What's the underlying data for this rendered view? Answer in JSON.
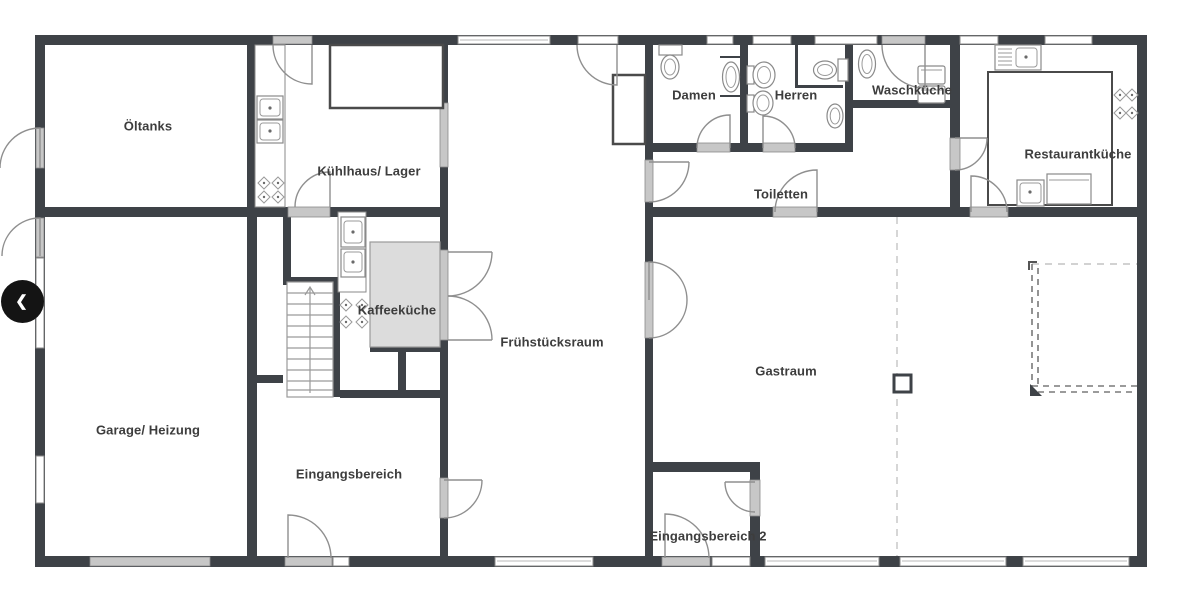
{
  "nav": {
    "prev_icon": "❮"
  },
  "rooms": {
    "oeltanks": {
      "label": "Öltanks"
    },
    "kuehlhaus": {
      "label": "Kühlhaus/ Lager"
    },
    "kaffeekueche": {
      "label": "Kaffeeküche"
    },
    "fruehstuecksraum": {
      "label": "Frühstücksraum"
    },
    "damen": {
      "label": "Damen"
    },
    "herren": {
      "label": "Herren"
    },
    "toiletten": {
      "label": "Toiletten"
    },
    "waschkueche": {
      "label": "Waschküche"
    },
    "restaurantkueche": {
      "label": "Restaurantküche"
    },
    "garage": {
      "label": "Garage/ Heizung"
    },
    "eingangsbereich": {
      "label": "Eingangsbereich"
    },
    "eingangsbereich2": {
      "label": "Eingangsbereich 2"
    },
    "gastraum": {
      "label": "Gastraum"
    }
  },
  "theme": {
    "wall": "#3e4247",
    "sill": "#c7c7c7",
    "outline": "#8a8a8a",
    "text": "#3d3d3d",
    "dashed_light": "#c4c4c4",
    "dashed_dark": "#7a7a7a",
    "button_bg": "#141414",
    "button_fg": "#ffffff",
    "canvas": "#ffffff"
  }
}
